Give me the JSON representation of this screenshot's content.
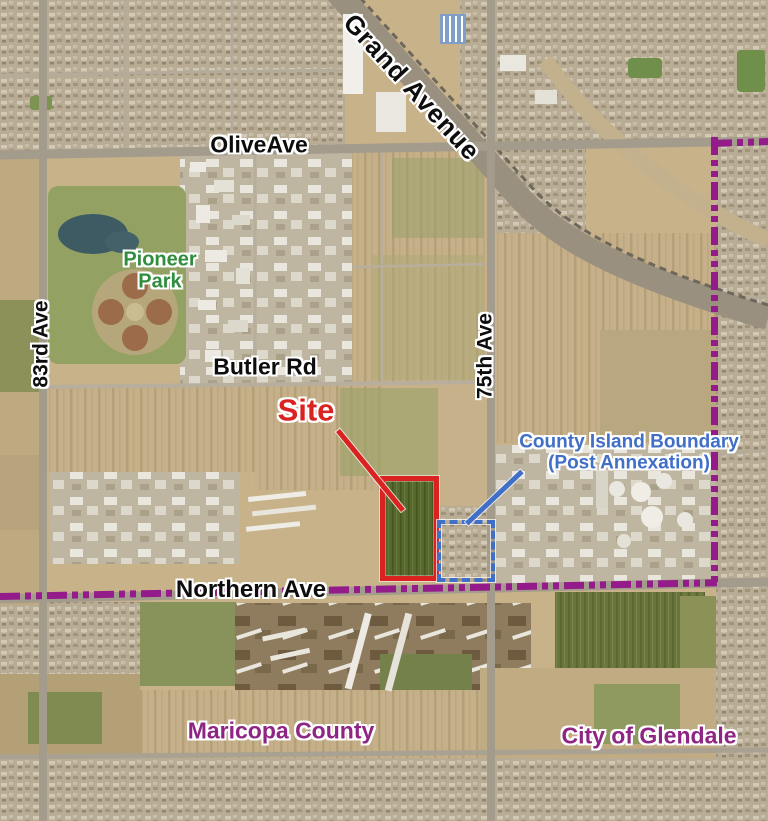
{
  "map": {
    "type": "aerial-annotation-exhibit",
    "street_labels": {
      "grand_avenue": "Grand Avenue",
      "olive_ave": "OliveAve",
      "butler_rd": "Butler Rd",
      "northern_ave": "Northern Ave",
      "eighty_third_ave": "83rd Ave",
      "seventy_fifth_ave": "75th Ave"
    },
    "place_labels": {
      "pioneer_park_line1": "Pioneer",
      "pioneer_park_line2": "Park",
      "maricopa_county": "Maricopa County",
      "city_of_glendale": "City of Glendale"
    },
    "annotations": {
      "site_label": "Site",
      "county_island_line1": "County Island Boundary",
      "county_island_line2": "(Post Annexation)"
    },
    "colors": {
      "site_red": "#da2220",
      "boundary_blue": "#3f6fc6",
      "county_text_purple": "#8e2584",
      "boundary_purple": "#941c8a",
      "park_green": "#2f8e3d",
      "road_label_black": "#0d0d0d"
    }
  }
}
